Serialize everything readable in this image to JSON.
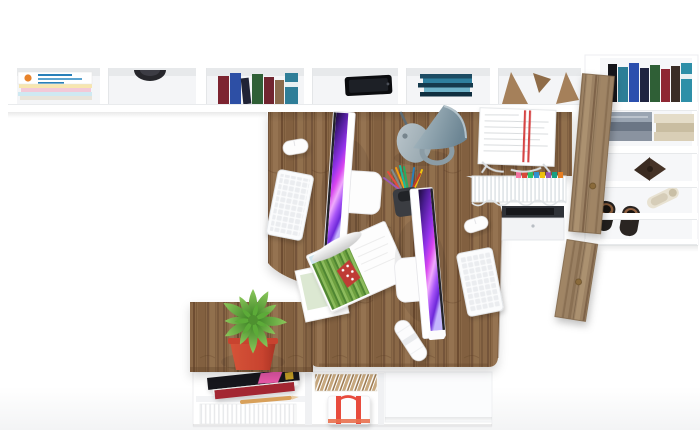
{
  "scene": {
    "description": "Top-down 3D render of a white home-office corner workstation with oak desktops, two iMac computers, a wall shelf, a wardrobe cabinet with open rustic-wood doors, a plant bench and low storage units",
    "background": "#ffffff",
    "monitor_count": 2,
    "keyboard_count": 2,
    "mouse_count": 2
  },
  "palette": {
    "desk_wood": "#8a6746",
    "desk_wood_dark": "#6f4f33",
    "desk_wood_light": "#957351",
    "door_wood": "#9b8164",
    "furniture_white": "#ffffff",
    "screen_purple_dark": "#1b0b38",
    "screen_purple": "#9333ea",
    "screen_pink": "#f0abfc",
    "lamp_gray": "#8b9ca5",
    "plant_green": "#5cab38",
    "pot_red": "#c8432f",
    "strap_red": "#e84c3d",
    "paper_stripe_red": "#d64545"
  },
  "wall_shelf": {
    "compartments": [
      {
        "name": "magazine-stack",
        "contents": "stack of flat magazines, top one white with orange logo and blue text",
        "colors": [
          "#ffffff",
          "#e8832a",
          "#2980b9",
          "#cfe9f2",
          "#f2c9d8",
          "#f7e6b0"
        ]
      },
      {
        "name": "dark-bowl",
        "contents": "dark round bowl seen edge-on",
        "colors": [
          "#26262b"
        ]
      },
      {
        "name": "standing-books",
        "contents": "seven upright books",
        "colors": [
          "#7d2430",
          "#2d4fa5",
          "#202335",
          "#2f5f36",
          "#712530",
          "#8a6b4d",
          "#2f7e98"
        ]
      },
      {
        "name": "smartphone",
        "contents": "black phone lying flat",
        "colors": [
          "#0b0c0f"
        ]
      },
      {
        "name": "flat-book-stack",
        "contents": "books stacked flat",
        "colors": [
          "#1d4c63",
          "#2e7f9e",
          "#153a4d",
          "#6fb3c9",
          "#0f2f40"
        ]
      },
      {
        "name": "wooden-bookends",
        "contents": "three angled wooden wedges",
        "colors": [
          "#a5805a",
          "#8f6c48"
        ]
      }
    ]
  },
  "wardrobe": {
    "shelves": [
      {
        "name": "books-row",
        "contents": "eight upright books",
        "colors": [
          "#15151a",
          "#2d7e97",
          "#2b4fae",
          "#1f2440",
          "#2f5f36",
          "#8f2733",
          "#3a2d26",
          "#2e8fa8"
        ]
      },
      {
        "name": "folded-clothes",
        "contents": "two piles of folded garments",
        "colors": [
          "#7f8a99",
          "#9aa5b2",
          "#d9ceb6",
          "#c9bda1"
        ]
      },
      {
        "name": "dark-bow",
        "contents": "dark bow / butterfly shaped object",
        "colors": [
          "#3a2b21"
        ]
      },
      {
        "name": "heeled-shoe",
        "contents": "ivory high-heel shoe",
        "colors": [
          "#e8e2d2"
        ]
      },
      {
        "name": "dark-shoes-pair",
        "contents": "pair of dark shoes with tan soles",
        "colors": [
          "#23201e",
          "#8a5c3a"
        ]
      }
    ],
    "doors": [
      {
        "name": "upper-door",
        "material": "rustic wood, open",
        "handle": "brass knob"
      },
      {
        "name": "lower-door",
        "material": "rustic wood, open",
        "handle": "brass knob"
      }
    ]
  },
  "desk": {
    "material": "rustic oak",
    "items": [
      {
        "name": "imac-left",
        "screen": "purple-magenta abstract wallpaper"
      },
      {
        "name": "imac-right",
        "screen": "purple-magenta abstract wallpaper"
      },
      {
        "name": "keyboard-left",
        "color": "#ffffff"
      },
      {
        "name": "keyboard-right",
        "color": "#ffffff"
      },
      {
        "name": "mouse-left",
        "color": "#ffffff"
      },
      {
        "name": "mouse-right",
        "color": "#ffffff"
      },
      {
        "name": "desk-lamp",
        "color": "#8b9ca5"
      },
      {
        "name": "pen-cup",
        "pen_colors": [
          "#e74c3c",
          "#f39c12",
          "#27ae60",
          "#2980b9",
          "#9b59b6",
          "#f1c40f",
          "#1abc9c",
          "#c0392b"
        ]
      },
      {
        "name": "document-tray",
        "contents": "white printed sheets with double red stripe"
      },
      {
        "name": "hanging-file-basket",
        "tab_colors": [
          "#ff78a9",
          "#e74c3c",
          "#2ecc71",
          "#3498db",
          "#f1c40f",
          "#9b59b6",
          "#16a085",
          "#e67e22"
        ]
      },
      {
        "name": "under-desk-pedestal",
        "contents": "dark equipment slot"
      },
      {
        "name": "open-magazine",
        "artwork": "green grass field with red polka-dot figure"
      },
      {
        "name": "postcard",
        "artwork": "pale green landscape"
      },
      {
        "name": "paper-roll",
        "color": "#ffffff"
      }
    ]
  },
  "bench": {
    "plant": {
      "type": "spiky succulent",
      "leaf_color": "#5cab38",
      "pot_color": "#c8432f"
    }
  },
  "lower_unit": {
    "sections": [
      {
        "name": "magazines",
        "colors": [
          "#15151a",
          "#e859a8",
          "#a32733"
        ]
      },
      {
        "name": "file-folders",
        "colors": [
          "#c7a87e"
        ]
      },
      {
        "name": "paper-files",
        "colors": [
          "#ffffff"
        ]
      },
      {
        "name": "pencil",
        "color": "#d8a05a"
      },
      {
        "name": "storage-box",
        "strap_color": "#e84c3d"
      },
      {
        "name": "drawer-front",
        "color": "#fbfcfd"
      }
    ]
  }
}
